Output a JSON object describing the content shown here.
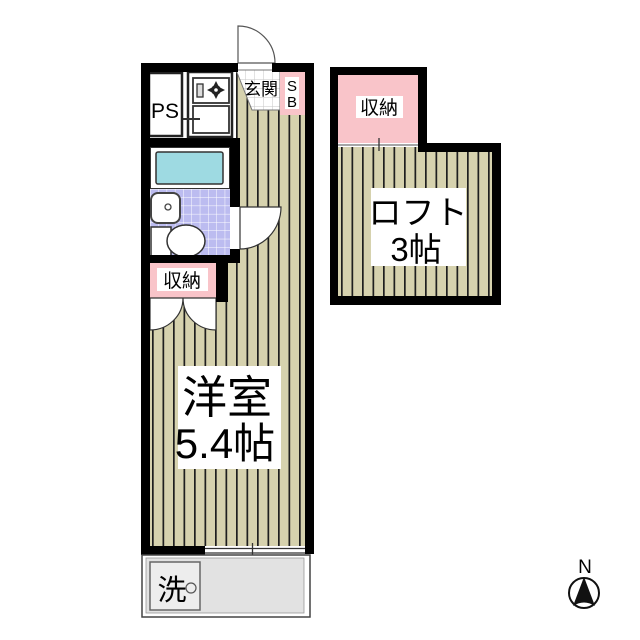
{
  "unit": {
    "ps_label": "PS",
    "entrance_label": "玄関",
    "shoebox_top": "S",
    "shoebox_bottom": "B",
    "closet_label": "収納",
    "room_label": "洋室",
    "room_size": "5.4帖",
    "washer_label": "洗"
  },
  "loft": {
    "closet_label": "収納",
    "name_label": "ロフト",
    "size_label": "3帖"
  },
  "compass": {
    "north_label": "N"
  },
  "colors": {
    "wall": "#000000",
    "flooring": "#d6d2ae",
    "floor_stripe": "#1f1f1f",
    "closet_pink": "#f9c4c9",
    "bath_tile": "#bcbcf0",
    "bathtub": "#9edae2",
    "entry_tile_line": "#c6c6c6",
    "balcony_gray": "#e2e2e2",
    "washer_gray": "#ededed"
  }
}
